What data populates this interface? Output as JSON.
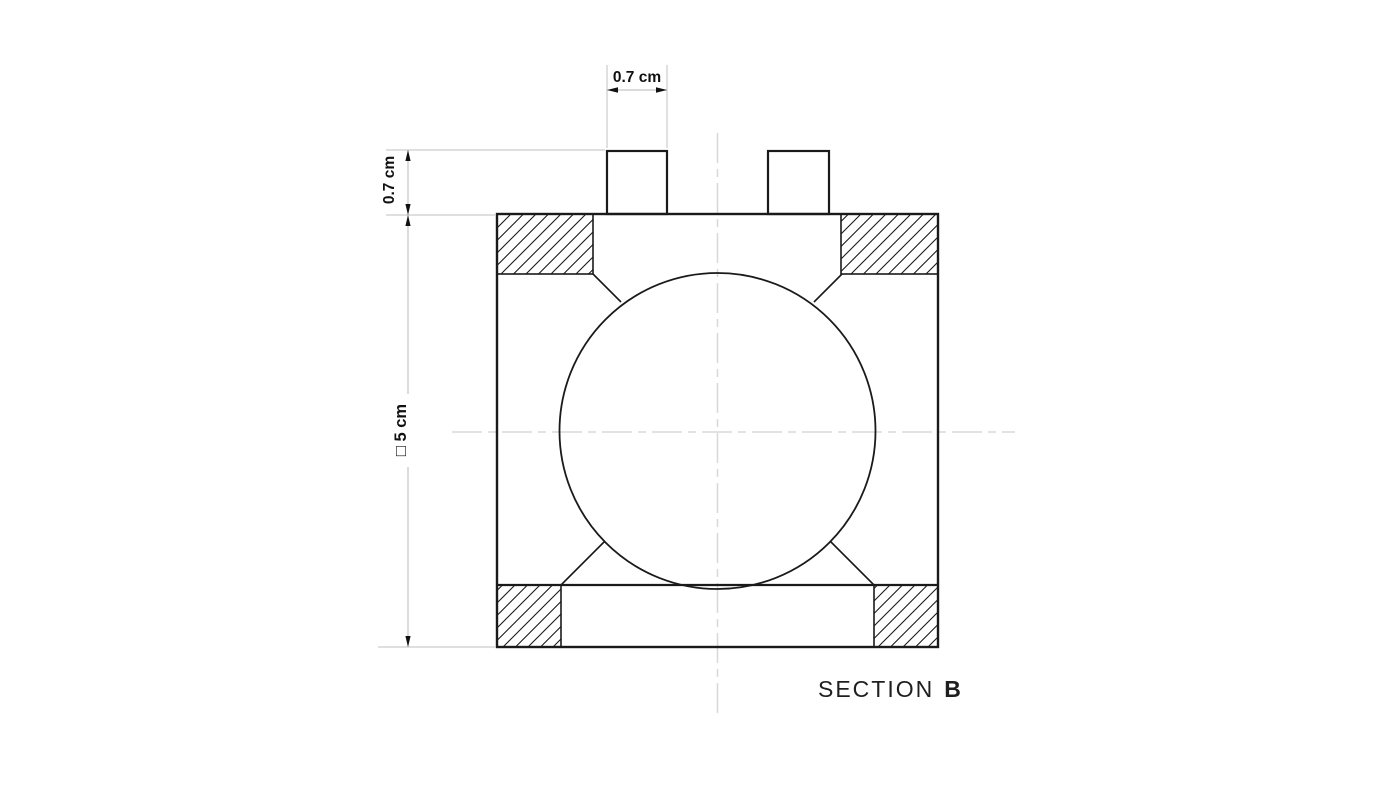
{
  "drawing": {
    "section_title": {
      "word": "SECTION",
      "letter": "B"
    },
    "dimension_labels": {
      "tab_width": "0.7 cm",
      "tab_height": "0.7 cm",
      "body_square": "□ 5 cm"
    },
    "colors": {
      "object_line": "#1a1a1a",
      "dimension_line": "#c4c4c4",
      "centerline": "#d8d8d8",
      "text": "#111111",
      "background": "#ffffff"
    }
  }
}
